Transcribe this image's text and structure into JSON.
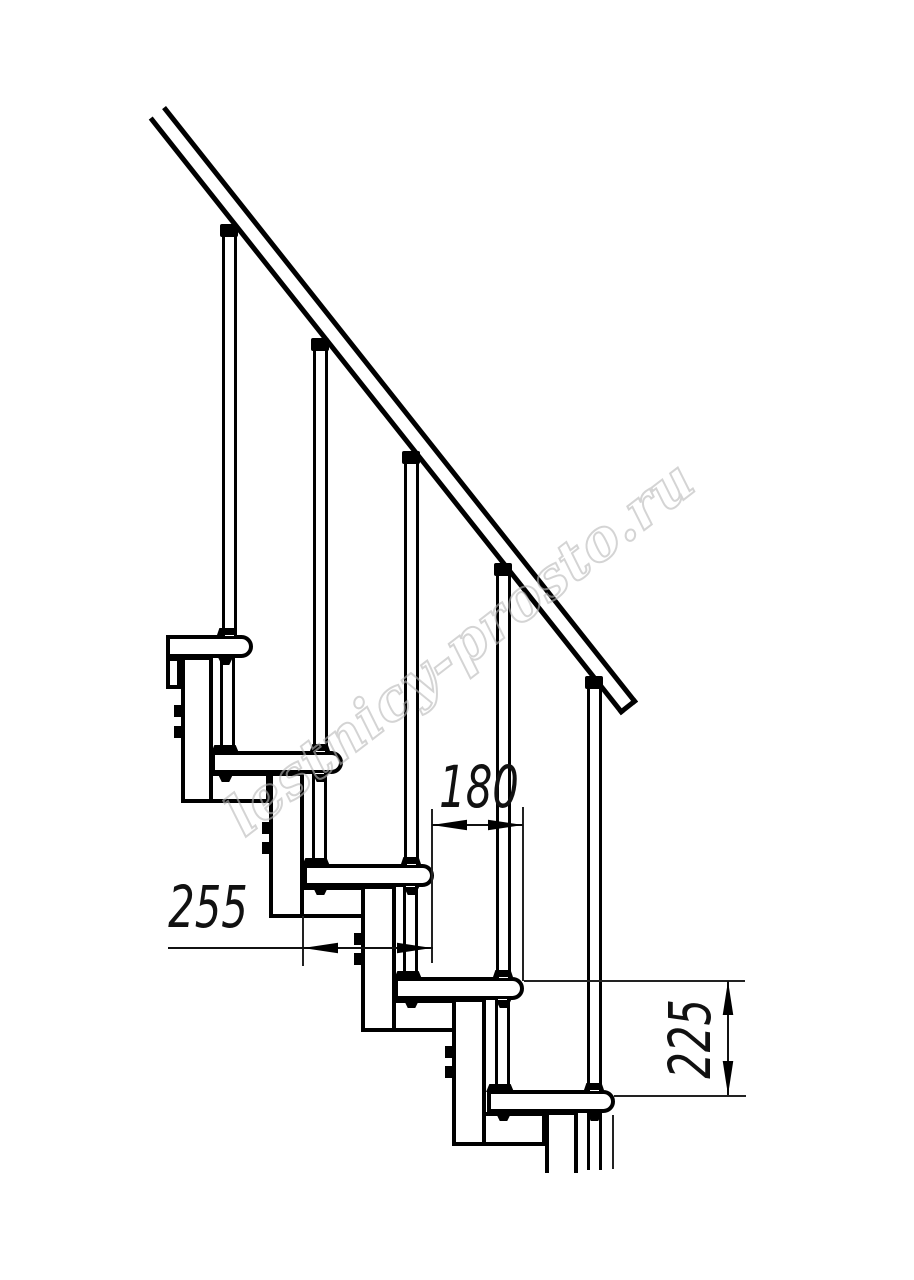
{
  "drawing": {
    "watermark_text": "lestnicy-prosto.ru",
    "dimension_step_run": "180",
    "dimension_step_length": "255",
    "dimension_step_rise": "225"
  }
}
